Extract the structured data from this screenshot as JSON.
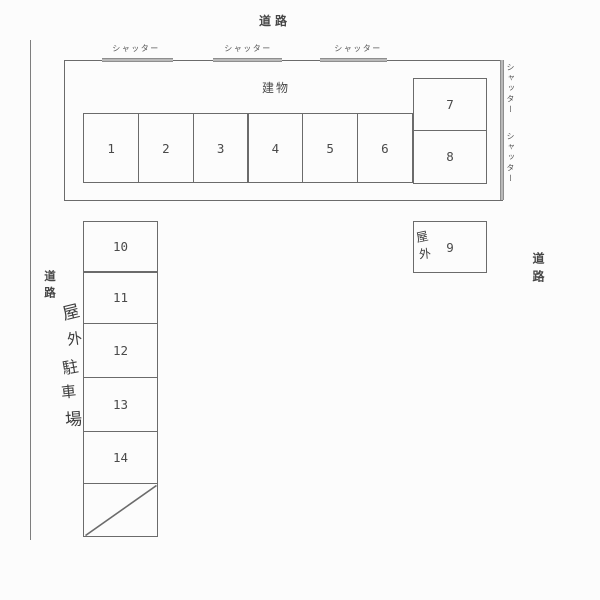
{
  "colors": {
    "background": "#fcfcfc",
    "line": "#6b6b6b",
    "shutter_bar": "#b9b9b9",
    "text": "#4a4a4a"
  },
  "roads": {
    "top": "道路",
    "left": "道路",
    "right": "道路"
  },
  "building": {
    "label": "建物",
    "top_shutters": [
      "シャッター",
      "シャッター",
      "シャッター"
    ],
    "right_shutters": [
      "シャッター",
      "シャッター"
    ],
    "stalls": [
      "1",
      "2",
      "3",
      "4",
      "5",
      "6"
    ],
    "side_stalls": [
      "7",
      "8"
    ]
  },
  "outdoor_box": {
    "label": "屋外",
    "label_chars": [
      "屋",
      "外"
    ],
    "number": "9"
  },
  "left_column": {
    "stalls": [
      "10",
      "11",
      "12",
      "13",
      "14"
    ]
  },
  "handwritten_label": {
    "text": "屋外駐車場",
    "chars": [
      "屋",
      "外",
      "駐",
      "車",
      "場"
    ]
  }
}
